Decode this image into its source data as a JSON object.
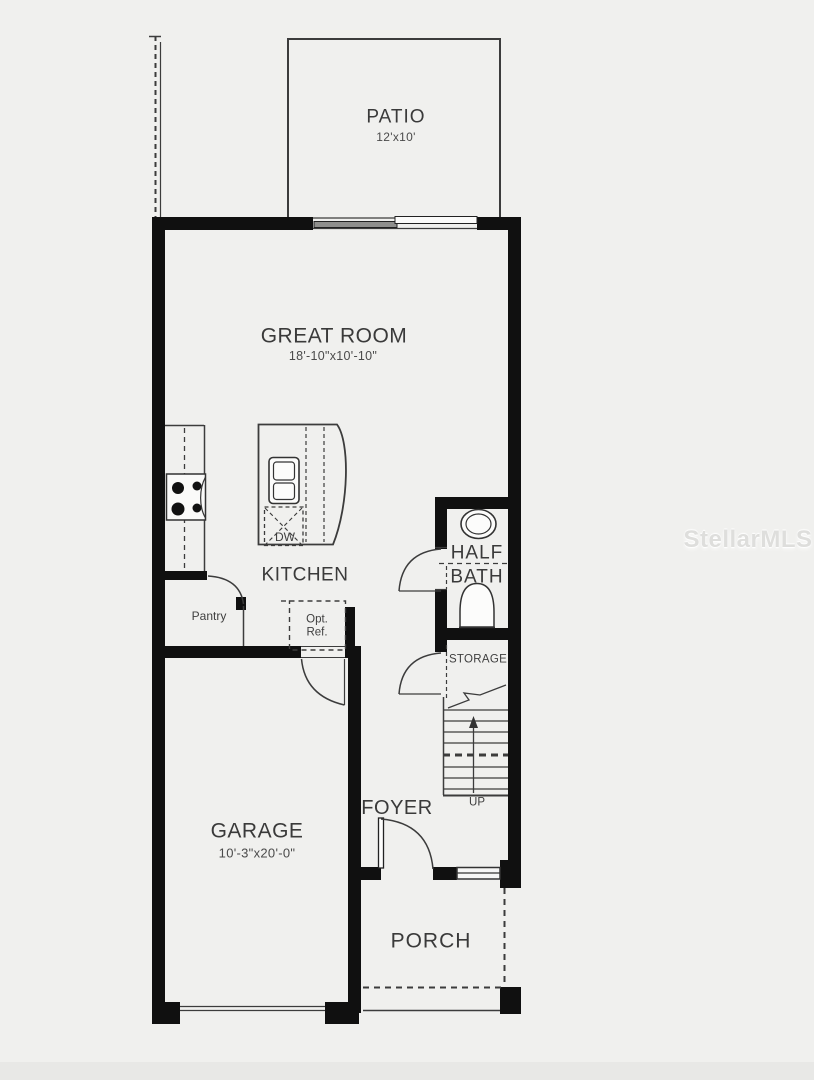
{
  "watermark": "StellarMLS",
  "colors": {
    "background": "#f0f0ee",
    "wall": "#101010",
    "line": "#3c3c3c",
    "label_text": "#3a3a3a",
    "watermark_text": "#dadad8"
  },
  "rooms": {
    "patio": {
      "name": "PATIO",
      "dims": "12'x10'"
    },
    "great_room": {
      "name": "GREAT ROOM",
      "dims": "18'-10\"x10'-10\""
    },
    "kitchen": {
      "name": "KITCHEN"
    },
    "pantry": {
      "name": "Pantry"
    },
    "half_bath": {
      "name_line1": "HALF",
      "name_line2": "BATH"
    },
    "storage": {
      "name": "STORAGE"
    },
    "foyer": {
      "name": "FOYER"
    },
    "garage": {
      "name": "GARAGE",
      "dims": "10'-3\"x20'-0\""
    },
    "porch": {
      "name": "PORCH"
    }
  },
  "fixtures": {
    "dishwasher_label": "DW",
    "opt_ref_line1": "Opt.",
    "opt_ref_line2": "Ref.",
    "stairs_up_label": "UP"
  }
}
